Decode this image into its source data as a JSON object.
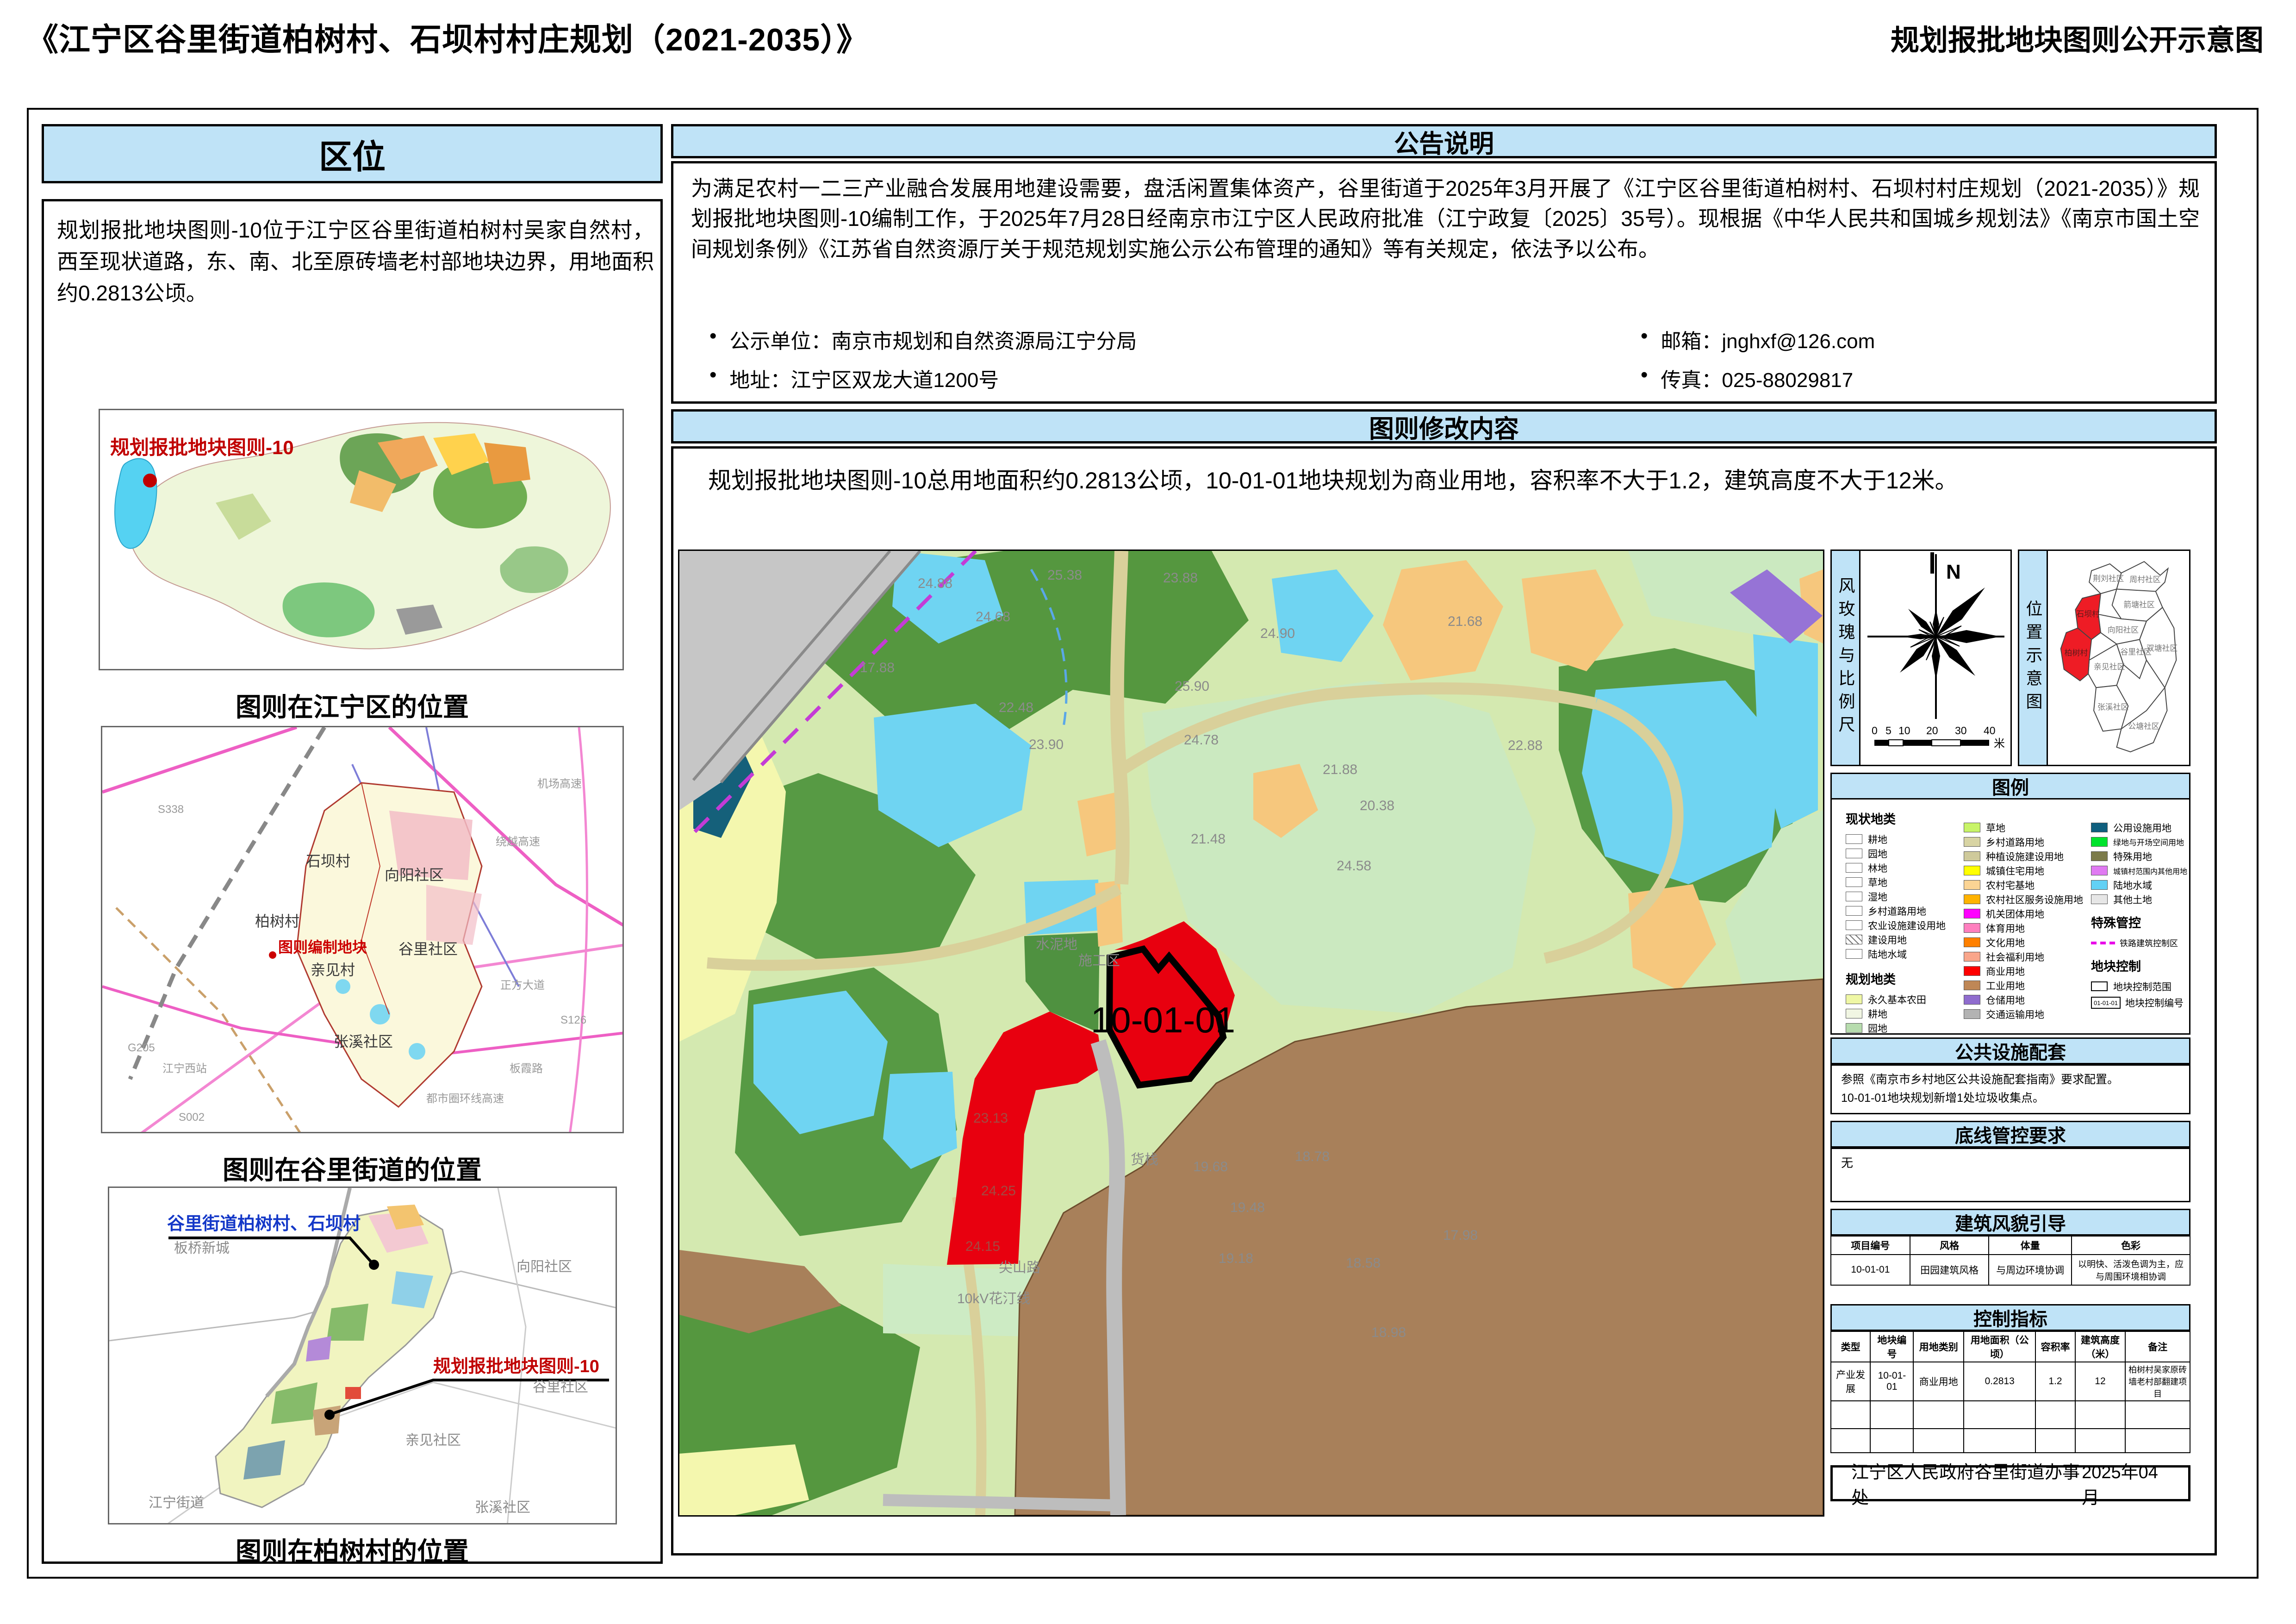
{
  "page": {
    "title": "《江宁区谷里街道柏树村、石坝村村庄规划（2021-2035）》",
    "subtitle": "规划报批地块图则公开示意图"
  },
  "location": {
    "header": "区位",
    "paragraph": "规划报批地块图则-10位于江宁区谷里街道柏树村吴家自然村，西至现状道路，东、南、北至原砖墙老村部地块边界，用地面积约0.2813公顷。",
    "map1": {
      "caption": "图则在江宁区的位置",
      "marker_label": "规划报批地块图则-10"
    },
    "map2": {
      "caption": "图则在谷里街道的位置",
      "marker_label": "图则编制地块",
      "labels": [
        "石坝村",
        "向阳社区",
        "柏树村",
        "谷里社区",
        "亲见村",
        "张溪社区"
      ],
      "road_labels": [
        "S338",
        "G205",
        "江宁西站",
        "S002",
        "绕越高速",
        "机场高速",
        "正方大道",
        "S126",
        "板霞路",
        "都市圈环线高速"
      ]
    },
    "map3": {
      "caption": "图则在柏树村的位置",
      "blue_label": "谷里街道柏树村、石坝村",
      "red_label": "规划报批地块图则-10",
      "labels": [
        "板桥新城",
        "向阳社区",
        "谷里社区",
        "亲见社区",
        "张溪社区",
        "江宁街道"
      ]
    }
  },
  "notice": {
    "header": "公告说明",
    "paragraph": "为满足农村一二三产业融合发展用地建设需要，盘活闲置集体资产，谷里街道于2025年3月开展了《江宁区谷里街道柏树村、石坝村村庄规划（2021-2035）》规划报批地块图则-10编制工作，于2025年7月28日经南京市江宁区人民政府批准（江宁政复〔2025〕35号）。现根据《中华人民共和国城乡规划法》《南京市国土空间规划条例》《江苏省自然资源厅关于规范规划实施公示公布管理的通知》等有关规定，依法予以公布。",
    "bullets": [
      "公示单位：南京市规划和自然资源局江宁分局",
      "地址：江宁区双龙大道1200号",
      "邮箱：jnghxf@126.com",
      "传真：025-88029817"
    ]
  },
  "modification": {
    "header": "图则修改内容",
    "paragraph": "规划报批地块图则-10总用地面积约0.2813公顷，10-01-01地块规划为商业用地，容积率不大于1.2，建筑高度不大于12米。"
  },
  "main_map": {
    "parcel_label": "10-01-01",
    "area_labels": [
      "施工区",
      "货栈",
      "尖山路",
      "10kV花汀线",
      "水泥地"
    ],
    "elevations": [
      "24.88",
      "25.38",
      "23.88",
      "24.68",
      "21.68",
      "17.88",
      "22.48",
      "23.90",
      "24.78",
      "25.90",
      "24.90",
      "21.88",
      "20.38",
      "21.48",
      "22.88",
      "24.58",
      "23.13",
      "24.25",
      "24.15",
      "19.68",
      "19.48",
      "18.78",
      "19.18",
      "18.58",
      "18.98",
      "17.98"
    ]
  },
  "sidebar": {
    "windrose": {
      "title": "风玫瑰与比例尺",
      "north": "N",
      "scale_ticks": [
        "0",
        "5",
        "10",
        "20",
        "30",
        "40"
      ],
      "scale_unit": "米"
    },
    "location_inset": {
      "title": "位置示意图",
      "highlight_color": "#ee1c25",
      "regions": [
        {
          "name": "荆刘社区",
          "highlight": false
        },
        {
          "name": "周村社区",
          "highlight": false
        },
        {
          "name": "箭塘社区",
          "highlight": false
        },
        {
          "name": "向阳社区",
          "highlight": false
        },
        {
          "name": "石坝村",
          "highlight": true
        },
        {
          "name": "柏树村",
          "highlight": true
        },
        {
          "name": "亲见社区",
          "highlight": false
        },
        {
          "name": "谷里社区",
          "highlight": false
        },
        {
          "name": "双塘社区",
          "highlight": false
        },
        {
          "name": "张溪社区",
          "highlight": false
        },
        {
          "name": "公塘社区",
          "highlight": false
        }
      ]
    },
    "legend": {
      "header": "图例",
      "current_title": "现状地类",
      "current": [
        {
          "label": "耕地",
          "color": "#ffffff"
        },
        {
          "label": "园地",
          "color": "#ffffff"
        },
        {
          "label": "林地",
          "color": "#ffffff"
        },
        {
          "label": "草地",
          "color": "#ffffff"
        },
        {
          "label": "湿地",
          "color": "#ffffff"
        },
        {
          "label": "乡村道路用地",
          "color": "#ffffff"
        },
        {
          "label": "农业设施建设用地",
          "color": "#ffffff"
        },
        {
          "label": "建设用地",
          "color": "#ffffff"
        },
        {
          "label": "陆地水域",
          "color": "#ffffff"
        }
      ],
      "planned_title": "规划地类",
      "planned_col1": [
        {
          "label": "永久基本农田",
          "color": "#eff7a5"
        },
        {
          "label": "耕地",
          "color": "#f1f6e3"
        },
        {
          "label": "园地",
          "color": "#b7dcae"
        },
        {
          "label": "林地",
          "color": "#5f9f52"
        }
      ],
      "planned_col2": [
        {
          "label": "草地",
          "color": "#c8f468"
        },
        {
          "label": "乡村道路用地",
          "color": "#d8d4a3"
        },
        {
          "label": "种植设施建设用地",
          "color": "#cfca9b"
        },
        {
          "label": "城镇住宅用地",
          "color": "#ffff00"
        },
        {
          "label": "农村宅基地",
          "color": "#fbd494"
        },
        {
          "label": "农村社区服务设施用地",
          "color": "#ffb300"
        },
        {
          "label": "机关团体用地",
          "color": "#ff00ff"
        },
        {
          "label": "体育用地",
          "color": "#ff7fbf"
        },
        {
          "label": "文化用地",
          "color": "#ff8000"
        },
        {
          "label": "社会福利用地",
          "color": "#f9a68b"
        },
        {
          "label": "商业用地",
          "color": "#fe0000"
        },
        {
          "label": "工业用地",
          "color": "#bf8756"
        },
        {
          "label": "仓储用地",
          "color": "#8f6cce"
        },
        {
          "label": "交通运输用地",
          "color": "#b3b3b3"
        }
      ],
      "planned_col3": [
        {
          "label": "公用设施用地",
          "color": "#0f5f7e"
        },
        {
          "label": "绿地与开场空间用地",
          "color": "#00e32d"
        },
        {
          "label": "特殊用地",
          "color": "#7c7b4a"
        },
        {
          "label": "城镇村范围内其他用地",
          "color": "#e07af2"
        },
        {
          "label": "陆地水域",
          "color": "#63d1f5"
        },
        {
          "label": "其他土地",
          "color": "#e6e6e6"
        }
      ],
      "special_title": "特殊管控",
      "special": [
        {
          "label": "铁路建筑控制区",
          "color": "#e800e8"
        }
      ],
      "control_title": "地块控制",
      "control": [
        {
          "label": "地块控制范围"
        },
        {
          "label": "地块控制编号",
          "code": "01-01-01"
        }
      ]
    },
    "facilities": {
      "header": "公共设施配套",
      "lines": [
        "参照《南京市乡村地区公共设施配套指南》要求配置。",
        "10-01-01地块规划新增1处垃圾收集点。"
      ]
    },
    "bottom_line": {
      "header": "底线管控要求",
      "content": "无"
    },
    "style_guide": {
      "header": "建筑风貌引导",
      "columns": [
        "项目编号",
        "风格",
        "体量",
        "色彩"
      ],
      "rows": [
        [
          "10-01-01",
          "田园建筑风格",
          "与周边环境协调",
          "以明快、活泼色调为主，应与周围环境相协调"
        ]
      ]
    },
    "control_indicators": {
      "header": "控制指标",
      "columns": [
        "类型",
        "地块编号",
        "用地类别",
        "用地面积（公顷）",
        "容积率",
        "建筑高度（米）",
        "备注"
      ],
      "rows": [
        [
          "产业发展",
          "10-01-01",
          "商业用地",
          "0.2813",
          "1.2",
          "12",
          "柏树村吴家原砖墙老村部翻建项目"
        ]
      ]
    },
    "footer": {
      "org": "江宁区人民政府谷里街道办事处",
      "date": "2025年04月"
    }
  }
}
